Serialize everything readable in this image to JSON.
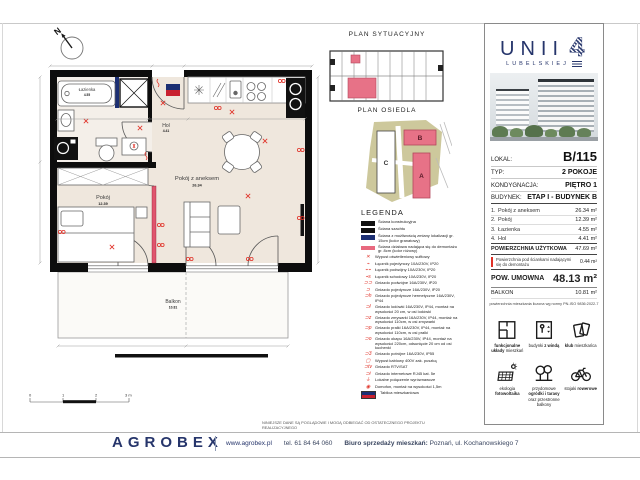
{
  "colors": {
    "brand_navy": "#26356b",
    "wall_navy": "#1c2f73",
    "wall_pink": "#e8697f",
    "symbol_red": "#e03127",
    "floor_beige": "#efe7dd",
    "site_khaki": "#cdc89c",
    "estate_pink": "#e77287"
  },
  "compass": {
    "north_label": "N"
  },
  "floor_plan": {
    "rooms": [
      {
        "name": "Łazienka",
        "area": "4.55"
      },
      {
        "name": "Hol",
        "area": "4.41"
      },
      {
        "name": "Pokój",
        "area": "12.39"
      },
      {
        "name": "Pokój z aneksem",
        "area": "26.34"
      },
      {
        "name": "Balkon",
        "area": "10.81"
      }
    ],
    "scale_bar": [
      "0",
      "1",
      "2",
      "3 m"
    ]
  },
  "mini_plans": {
    "situational_title": "PLAN SYTUACYJNY",
    "estate_title": "PLAN OSIEDLA",
    "buildings": {
      "a": "A",
      "b": "B",
      "c": "C"
    }
  },
  "legend": {
    "title": "LEGENDA",
    "walls": [
      {
        "label": "Ściana konstrukcyjna"
      },
      {
        "label": "Ściana szachtu"
      },
      {
        "label": "Ściana z możliwością zmiany lokalizacji gr. 15cm (kolor granatowy)"
      },
      {
        "label": "Ściana działowa nadająca się do demontażu gr. 8cm (kolor różowy)"
      }
    ],
    "symbols": [
      {
        "glyph": "✕",
        "label": "Wypust oświetleniowy sufitowy"
      },
      {
        "glyph": "⌁",
        "label": "Łącznik pojedynczy 10A/230V, IP20"
      },
      {
        "glyph": "⌁⌁",
        "label": "Łącznik podwójny 10A/230V, IP20"
      },
      {
        "glyph": "⌁s",
        "label": "Łącznik schodowy 10A/230V, IP20"
      },
      {
        "glyph": "⊃⊃",
        "label": "Gniazdo podwójne 16A/230V, IP20"
      },
      {
        "glyph": "⊃",
        "label": "Gniazdo pojedyncze 16A/230V, IP20"
      },
      {
        "glyph": "⊃h",
        "label": "Gniazdo pojedyncze hermetyczne 16A/230V, IP44"
      },
      {
        "glyph": "⊃l",
        "label": "Gniazdo lodówki 16A/230V, IP44, montaż na wysokości 20 cm, w osi lodówki"
      },
      {
        "glyph": "⊃z",
        "label": "Gniazdo zmywarki 16A/230V, IP44, montaż na wysokości 110cm, w osi zmywarki"
      },
      {
        "glyph": "⊃p",
        "label": "Gniazdo pralki 16A/230V, IP44, montaż na wysokości 110cm, w osi pralki"
      },
      {
        "glyph": "⊃o",
        "label": "Gniazdo okapu 16A/230V, IP44, montaż na wysokości 220cm, odsunięcie 20 cm od osi kuchenki"
      },
      {
        "glyph": "⊃3",
        "label": "Gniazdo potrójne 16A/230V, IP55"
      },
      {
        "glyph": "▢",
        "label": "Wypust kablowy 400V zak. puszką"
      },
      {
        "glyph": "⊃tv",
        "label": "Gniazdo RTV/SAT"
      },
      {
        "glyph": "⊃i",
        "label": "Gniazdo internetowe RJ45 kat. 5e"
      },
      {
        "glyph": "⏚",
        "label": "Lokalne połączenie wyrównawcze"
      },
      {
        "glyph": "◉",
        "label": "Domofon, montaż na wysokości 1,5m"
      },
      {
        "glyph": "",
        "label": "Tablica mieszkaniowa"
      }
    ]
  },
  "card": {
    "logo": {
      "name": "UNII",
      "number": "4",
      "sub": "LUBELSKIEJ"
    },
    "info_rows": [
      {
        "label": "LOKAL:",
        "value": "B/115"
      },
      {
        "label": "TYP:",
        "value": "2 POKOJE"
      },
      {
        "label": "KONDYGNACJA:",
        "value": "PIĘTRO 1"
      },
      {
        "label": "BUDYNEK:",
        "value": "ETAP I - BUDYNEK B"
      }
    ],
    "rooms": [
      {
        "no": "1.",
        "name": "Pokój z aneksem",
        "area": "26.34 m²"
      },
      {
        "no": "2.",
        "name": "Pokój",
        "area": "12.39 m²"
      },
      {
        "no": "3.",
        "name": "Łazienka",
        "area": "4.55 m²"
      },
      {
        "no": "4.",
        "name": "Hol",
        "area": "4.41 m²"
      }
    ],
    "usable": {
      "label": "POWIERZCHNIA UŻYTKOWA",
      "value": "47.69 m²"
    },
    "demountable": {
      "label": "Powierzchnia pod ściankami nadającymi się do demontażu",
      "value": "0.44 m²"
    },
    "contract": {
      "label": "POW. UMOWNA",
      "value": "48.13 m²"
    },
    "balcony": {
      "label": "BALKON",
      "value": "10.81 m²"
    },
    "norm_note": "powierzchnia mieszkania liczona wg normy PN-ISO 9836:2022-7",
    "features": [
      {
        "pre": "",
        "bold": "funkcjonalne układy",
        "post": " mieszkań"
      },
      {
        "pre": "budynki ",
        "bold": "z windą",
        "post": ""
      },
      {
        "pre": "",
        "bold": "klub",
        "post": " mieszkańca"
      },
      {
        "pre": "ekologia ",
        "bold": "fotowoltaika",
        "post": ""
      },
      {
        "pre": "przydomowe ",
        "bold": "ogródki i tarasy",
        "post": " oraz przestronne balkony"
      },
      {
        "pre": "stojaki ",
        "bold": "rowerowe",
        "post": ""
      }
    ]
  },
  "disclaimer": "NINIEJSZE DANE SĄ POGLĄDOWE I MOGĄ ODBIEGAĆ OD OSTATECZNEGO PROJEKTU REALIZACYJNEGO",
  "footer": {
    "brand": "AGROBEX",
    "website": "www.agrobex.pl",
    "phone": "tel. 61 84 64 060",
    "office_label": "Biuro sprzedaży mieszkań:",
    "office_value": "Poznań, ul. Kochanowskiego 7"
  }
}
